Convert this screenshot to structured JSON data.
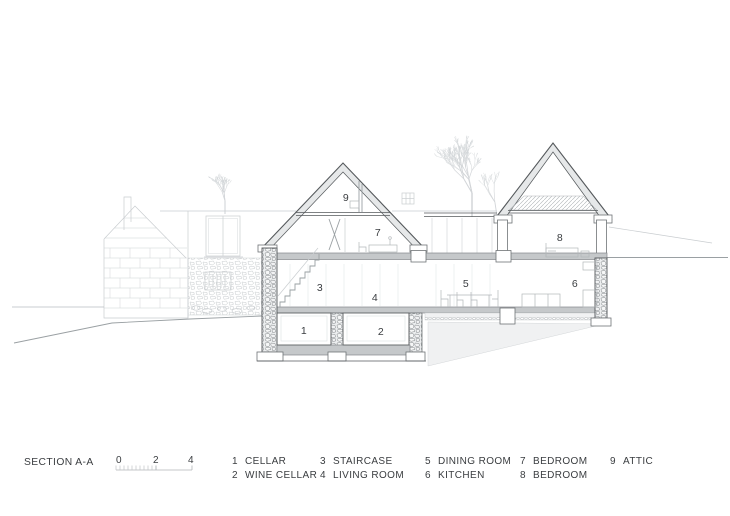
{
  "title": "SECTION A-A",
  "scale": {
    "labels": [
      "0",
      "2",
      "4"
    ]
  },
  "rooms": [
    {
      "num": "1",
      "name": "CELLAR"
    },
    {
      "num": "2",
      "name": "WINE CELLAR"
    },
    {
      "num": "3",
      "name": "STAIRCASE"
    },
    {
      "num": "4",
      "name": "LIVING ROOM"
    },
    {
      "num": "5",
      "name": "DINING ROOM"
    },
    {
      "num": "6",
      "name": "KITCHEN"
    },
    {
      "num": "7",
      "name": "BEDROOM"
    },
    {
      "num": "8",
      "name": "BEDROOM"
    },
    {
      "num": "9",
      "name": "ATTIC"
    }
  ],
  "colors": {
    "line-dark": "#54585b",
    "line-med": "#9aa0a3",
    "line-light": "#c9cdd0",
    "ink": "#3a3d40",
    "background": "#ffffff"
  }
}
